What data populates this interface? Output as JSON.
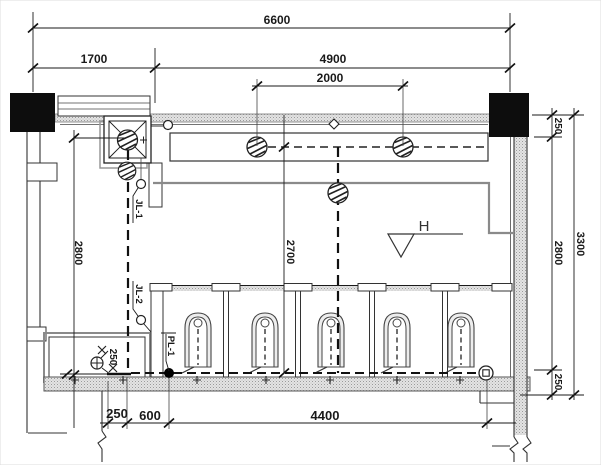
{
  "colors": {
    "ink": "#1a1a1a",
    "wall_gray": "#8a8a8a",
    "column_black": "#0d0d0d",
    "paper": "#ffffff"
  },
  "dimensions": {
    "top": {
      "total": "6600",
      "left_bay": "1700",
      "right_bay": "4900",
      "light_spacing": "2000"
    },
    "left": {
      "riser_run": "2800"
    },
    "center": {
      "circuit_run": "2700"
    },
    "right": {
      "top_offset": "250",
      "room_height": "2800",
      "bottom_offset": "250",
      "total": "3300"
    },
    "bottom": {
      "wall_to_wire": "250",
      "wire_to_drain": "600",
      "main_run": "4400"
    },
    "mop_room": {
      "fixture_offset": "250"
    }
  },
  "labels": {
    "riser_1": "JL-1",
    "riser_2": "JL-2",
    "drain_pipe": "PL-1",
    "elevation_mark": "H"
  },
  "symbols": {
    "ceiling_fan": 1,
    "hatched_lights": 5,
    "squat_toilets": 5,
    "stall_partitions": 4,
    "junction_dot": 1,
    "ground_terminal": 1,
    "wall_outlets": 2,
    "columns": 2
  }
}
